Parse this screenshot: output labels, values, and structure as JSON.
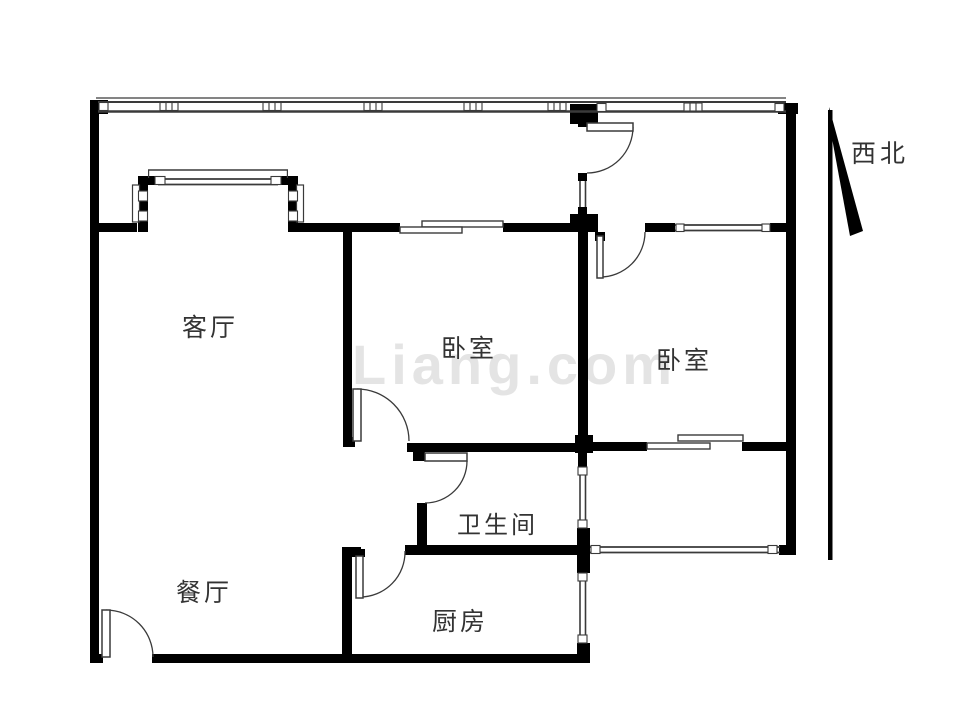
{
  "page": {
    "background": "#ffffff"
  },
  "rooms": {
    "living_room": {
      "label": "客厅"
    },
    "dining_room": {
      "label": "餐厅"
    },
    "bedroom_1": {
      "label": "卧室"
    },
    "bedroom_2": {
      "label": "卧室"
    },
    "bathroom": {
      "label": "卫生间"
    },
    "kitchen": {
      "label": "厨房"
    }
  },
  "compass": {
    "label": "西北"
  },
  "watermark": {
    "text": "Liang.com"
  },
  "features": {
    "doors": [
      "entry-door",
      "balcony-partition-door",
      "bedroom-2-door",
      "bedroom-1-door",
      "bathroom-door",
      "kitchen-door"
    ],
    "sliding_doors": [
      "bedroom-1-north-sliding-door",
      "bedroom-2-south-sliding-door"
    ],
    "windows": [
      "north-window-band",
      "living-room-bay-window",
      "bedroom-2-north-window",
      "bedroom-2-south-window",
      "bathroom-side-window",
      "kitchen-side-window"
    ]
  },
  "colors": {
    "wall": "#000000",
    "line": "#3a3a3a",
    "text": "#333333",
    "watermark": "#e4e4e4"
  }
}
